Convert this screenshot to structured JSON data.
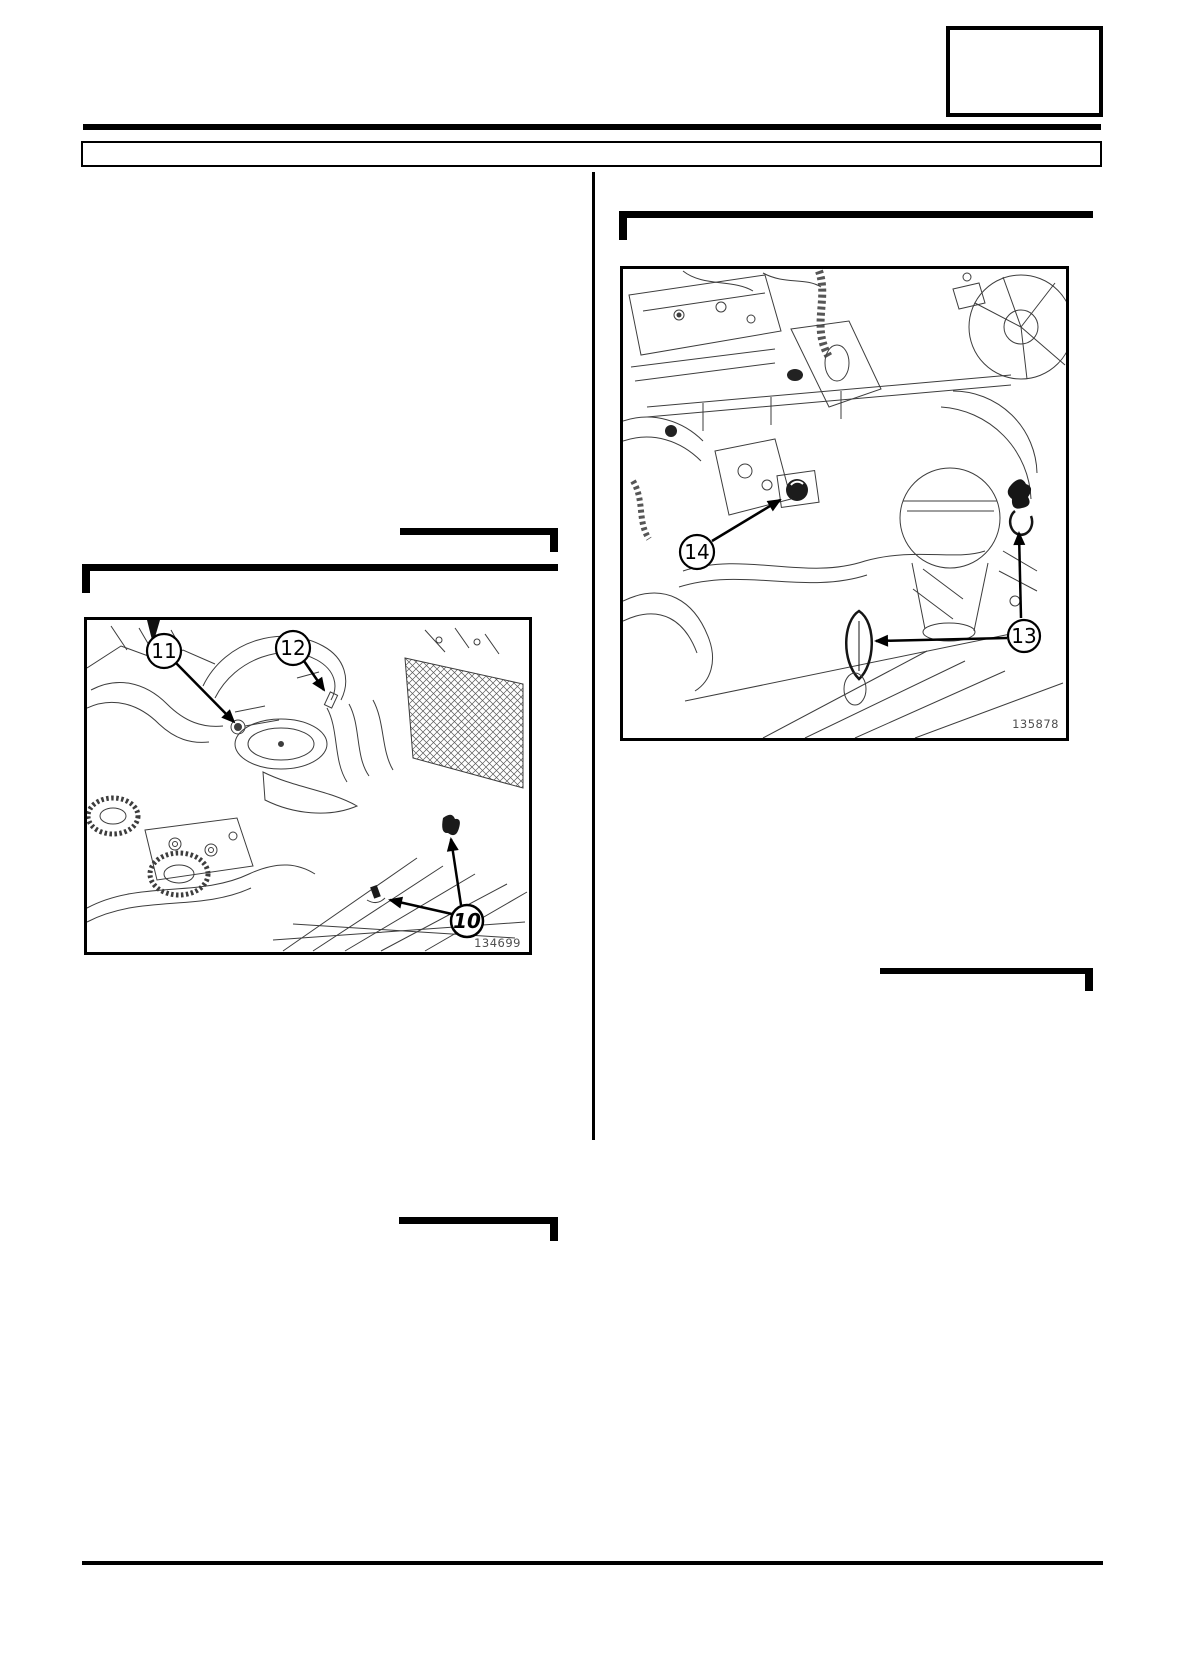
{
  "page": {
    "top_right_box_text": "",
    "header_bar_text": ""
  },
  "figures": {
    "left": {
      "ref": "134699",
      "callouts": {
        "c11": "11",
        "c12": "12",
        "c10": "10"
      }
    },
    "right": {
      "ref": "135878",
      "callouts": {
        "c14": "14",
        "c13": "13"
      }
    }
  }
}
